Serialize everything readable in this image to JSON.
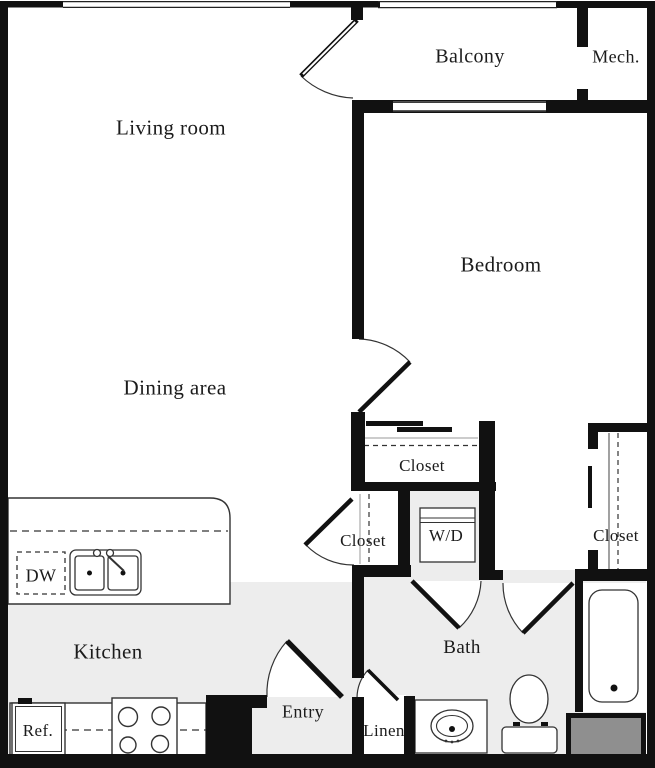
{
  "title": "One-bedroom apartment floor plan",
  "colors": {
    "wall": "#111111",
    "floor_shaded": "#ededed",
    "shaft_fill": "#8f8f8f",
    "line": "#333333",
    "text": "#1b1b1b",
    "background": "#ffffff"
  },
  "rooms": {
    "living_room": "Living room",
    "balcony": "Balcony",
    "mech": "Mech.",
    "bedroom": "Bedroom",
    "dining": "Dining area",
    "kitchen": "Kitchen",
    "bath": "Bath",
    "entry": "Entry"
  },
  "closets": {
    "bedroom_reach_in": "Closet",
    "hall": "Closet",
    "bedroom_walk_in": "Closet",
    "linen": "Linen"
  },
  "appliances": {
    "dishwasher": "DW",
    "washer_dryer": "W/D",
    "refrigerator": "Ref."
  }
}
